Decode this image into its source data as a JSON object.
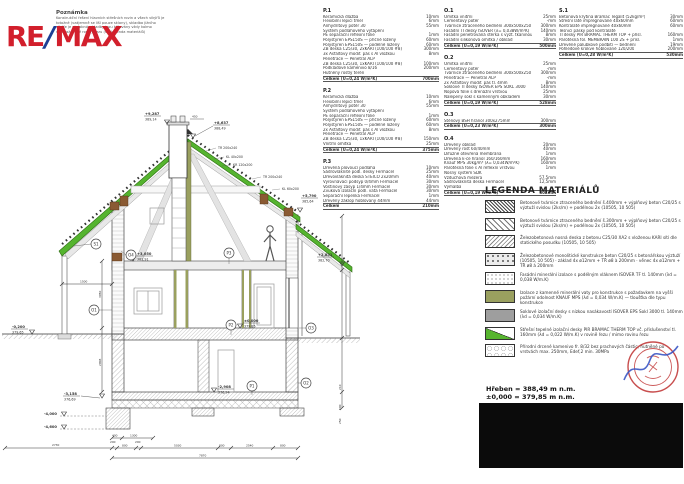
{
  "note": {
    "title": "Poznámka",
    "lines": [
      "Konstrukční řešení hlavních střešních rovin a všech vikýřů je",
      "totožné (vzájemně se liší pouze sklony), skladba jižního",
      "vikýře je obdobná, skladby jsou kótovány vždy kolmo",
      "na uvažované roviny řezu (viz legenda materiálů)"
    ]
  },
  "logo": {
    "re": "RE",
    "slash": "/",
    "max": "MAX"
  },
  "specs": {
    "p1": {
      "id": "P.1",
      "rows": [
        [
          "Keramická dlažba",
          "10mm"
        ],
        [
          "Flexibilní lepicí tmel",
          "6mm"
        ],
        [
          "Anhydritový potěr 30",
          "55mm"
        ],
        [
          "Systém podlahového vytápění",
          ""
        ],
        [
          "PE separační reflexní fólie",
          "1mm"
        ],
        [
          "Polystyren EPS150S — příčně ložený",
          "60mm"
        ],
        [
          "Polystyren EPS150S — podélně ložený",
          "60mm"
        ],
        [
          "ŽB deska C25/30, 2xKARI (100/100 #8)",
          "300mm"
        ],
        [
          "3x Asfaltový modif. pás s Al vložkou",
          "8mm"
        ],
        [
          "Penetrace — Penetral ALP",
          ""
        ],
        [
          "ŽB deska C25/30, 1xKARI (100/100 #8)",
          "100mm"
        ],
        [
          "Podkladové kamenivo 8/16",
          "200mm"
        ],
        [
          "Hutněný rostlý terén",
          ""
        ]
      ],
      "total": [
        "Celkem (U=0,24 W/m²K)",
        "700mm"
      ]
    },
    "p2": {
      "id": "P.2",
      "rows": [
        [
          "Keramická dlažba",
          "10mm"
        ],
        [
          "Flexibilní lepicí tmel",
          "6mm"
        ],
        [
          "Anhydritový potěr 30",
          "55mm"
        ],
        [
          "Systém podlahového vytápění",
          ""
        ],
        [
          "PE separační reflexní fólie",
          "1mm"
        ],
        [
          "Polystyren EPS150S — příčně ložený",
          "60mm"
        ],
        [
          "Polystyren EPS150S — podélně ložený",
          "60mm"
        ],
        [
          "2x Asfaltový modif. pás s Al vložkou",
          "8mm"
        ],
        [
          "Penetrace — Penetral ALP",
          ""
        ],
        [
          "ŽB deska C25/30, 1xKARI (100/100 #8)",
          "150mm"
        ],
        [
          "Vnitřní omítka",
          "25mm"
        ]
      ],
      "total": [
        "Celkem (U=0,24 W/m²K)",
        "375mm"
      ]
    },
    "p3": {
      "id": "P.3",
      "rows": [
        [
          "Dřevěná plovoucí podlaha",
          "10mm"
        ],
        [
          "Sádrovláknité podl. desky Fermacel",
          "25mm"
        ],
        [
          "Dřevovláknitá deska STEICO 2x20mm",
          "40mm"
        ],
        [
          "Vyrovnávací podsyp 0/4mm Fermacel",
          "30mm"
        ],
        [
          "Voštinový zásyp 1/4mm Fermacel",
          "30mm"
        ],
        [
          "Zvuková izolační podl. vata Fermacel",
          "30mm"
        ],
        [
          "Separační lepenka Fermacel",
          "1mm"
        ],
        [
          "Dřevěný záklop hoblovaný 44mm",
          "44mm"
        ]
      ],
      "total": [
        "Celkem",
        "210mm"
      ]
    },
    "o1": {
      "id": "O.1",
      "rows": [
        [
          "Omítka vnitřní",
          "25mm"
        ],
        [
          "Cementový potěr",
          "-mm"
        ],
        [
          "Tvárnice ztraceného bednění 300x500x250",
          "300mm"
        ],
        [
          "Fasádní TI desky ISOVER (λ= 0,038W/m²K)",
          "140mm"
        ],
        [
          "Fasádní penetrovaná stěrka s výzt. tkaninou",
          "8mm"
        ],
        [
          "Fasádní silikonová omítka / obklad",
          "30mm"
        ]
      ],
      "total": [
        "Celkem (U=0,19 W/m²K)",
        "500mm"
      ]
    },
    "o2": {
      "id": "O.2",
      "rows": [
        [
          "Omítka vnitřní",
          "25mm"
        ],
        [
          "Cementový potěr",
          "-mm"
        ],
        [
          "Tvárnice ztraceného bednění 300x500x250",
          "300mm"
        ],
        [
          "Penetrace — Penetral ALP",
          "-mm"
        ],
        [
          "2x Asfaltový modif. pás tl. 4mm",
          "8mm"
        ],
        [
          "Soklové TI desky ISOVER EPS SOKL 3000",
          "140mm"
        ],
        [
          "Nopová fólie s drenážní vrstvou",
          "25mm"
        ],
        [
          "Nalepený sokl s kamenným obkladem",
          "30mm"
        ]
      ],
      "total": [
        "Celkem (U=0,19 W/m²K)",
        "528mm"
      ]
    },
    "o3": {
      "id": "O.3",
      "rows": [
        [
          "Stěnový BSH hranol 300x275mm",
          "300mm"
        ]
      ],
      "total": [
        "Celkem (U=0,23 W/m²K)",
        "300mm"
      ]
    },
    "o4": {
      "id": "O.4",
      "rows": [
        [
          "Dřevěný obklad",
          "20mm"
        ],
        [
          "Dřevěný rošt 60/40mm",
          "40mm"
        ],
        [
          "Difúzně otevřená membrána",
          "1mm"
        ],
        [
          "Dřevěná k-ce hranol 160/160mm",
          "160mm"
        ],
        [
          "Knauf MPS 30kg/m³ (λ= 0,034W/m²K)",
          "160mm"
        ],
        [
          "Parotěsná fólie s Al reflexní vrstvou",
          "1mm"
        ],
        [
          "Nosný systém SDK",
          ""
        ],
        [
          "Vzduchová mezera",
          "57,5mm"
        ],
        [
          "Sádrovláknitá deska Fermacel",
          "12,5mm"
        ],
        [
          "Výmalba",
          ""
        ]
      ],
      "total": [
        "Celkem (U=0,19 W/m²K)",
        "302mm"
      ]
    },
    "s1": {
      "id": "S.1",
      "rows": [
        [
          "Betonová krytina Bramac Tegalit (52kg/m²)",
          "30mm"
        ],
        [
          "Střešní latě impregnované 40x60mm",
          "60mm"
        ],
        [
          "Kontralatě impregnované 40x60mm",
          "60mm"
        ],
        [
          "Těsnicí pásky pod kontralatě",
          ""
        ],
        [
          "TI desky PIR BRAMAC THERM TOP + přísl.",
          "160mm"
        ],
        [
          "Parotěsná fol. MEMBRAIN 100 2S + přísl.",
          "1mm"
        ],
        [
          "Dřevěné palubkové podbití — bednění",
          "19mm"
        ],
        [
          "Pohledové krokve hoblované 120/200",
          "200mm"
        ]
      ],
      "total": [
        "Celkem (U=0,28 W/m²K)",
        "530mm"
      ]
    }
  },
  "legend": {
    "title": "LEGENDA MATERIÁLŮ",
    "items": [
      {
        "swatch": "dark-block-hatch",
        "text": "Betonové tvárnice ztraceného bednění š.400mm + výplňový beton C20/25 s výztuží svislou (2ks/m) + podélnou 2x (10505, 10 505)"
      },
      {
        "swatch": "light-block-hatch",
        "text": "Betonové tvárnice ztraceného bednění š.300mm + výplňový beton C20/25 s výztuží svislou (2ks/m) + podélnou 2x (10505, 10 505)"
      },
      {
        "swatch": "rc-slab-hatch",
        "text": "Železobetonová nosná deska z betonu C25/30 XA2 s vloženou KARI sítí dle statického posudku (10505, 10 505)"
      },
      {
        "swatch": "concrete-dots",
        "text": "Železobetonové monolitické konstrukce beton C20/25 s betonářskou výztuží (10505, 10 505) · základ 4x ø12mm + TŘ ø8 à 200mm · věnec 4x ø12mm + TŘ ø8 à 200mm"
      },
      {
        "swatch": "mineral-dots",
        "text": "Fasádní minerální izolace s podélným vláknem ISOVER TF tl. 140mm (λd = 0,038 W/m.K)"
      },
      {
        "swatch": "olive-solid",
        "text": "Izolace z kamenné minerální vaty pro konstrukce s požadavkem na vyšší požární odolnost KNAUF MPS (λd = 0,034 W/m.K) — tloušťka dle typu konstrukce"
      },
      {
        "swatch": "grey-solid",
        "text": "Soklové izolační desky s nízkou nasákavostí ISOVER EPS Sokl 3000 tl. 140mm (λd = 0,034 W/m.K)"
      },
      {
        "swatch": "green-split",
        "text": "Střešní tepelné izolační desky PIR BRAMAC THERM TOP vč. příslušenství tl. 160mm (λd = 0,022 W/m.K) v rovině řezu / mimo rovinu řezu"
      },
      {
        "swatch": "gravel-circles",
        "text": "Přírodní drcené kamenivo fr. 8/32 bez prachových částic, hutněné po vrstvách max. 250mm, Edef,2 min. 30MPa"
      }
    ]
  },
  "levels": {
    "ridge": "Hřeben = 388,49 m n.m.",
    "zero": "±0,000 = 379,85 m n.m."
  },
  "drawing": {
    "elev": {
      "chimney": {
        "v": "+9,287",
        "d": "389,14"
      },
      "ridge": {
        "v": "+8,637",
        "d": "388,49"
      },
      "eave_r": {
        "v": "+5,790",
        "d": "385,64"
      },
      "eave_low": {
        "v": "+2,851",
        "d": "382,70"
      },
      "floor1": {
        "v": "+3,050",
        "d": "382,91"
      },
      "zero": {
        "v": "±0,000",
        "d": "379,85"
      },
      "grade": {
        "v": "-0,200",
        "d": "379,65"
      },
      "footing_top": {
        "v": "-3,158",
        "d": "376,69"
      },
      "bsm_floor": {
        "v": "-2,908",
        "d": "376,94"
      },
      "footing_a": {
        "v": "-4,000"
      },
      "footing_b": {
        "v": "-4,600"
      }
    },
    "members": {
      "tr1": "TR 200x240",
      "kl1": "KL 40x200",
      "kr1": "KR 120x200",
      "tr2": "TR 200x240",
      "kl2": "KL 60x200"
    },
    "bubbles": {
      "s1": "S1",
      "o1": "O1",
      "o2": "O2",
      "o3": "O3",
      "o4": "O4",
      "p1": "P1",
      "p2": "P2",
      "p3": "P3"
    },
    "dims": {
      "b1": "2730",
      "b2": "200",
      "b3": "800",
      "b4": "200",
      "b5": "5030",
      "b6": "800",
      "b7": "2540",
      "b8": "800",
      "total": "7870",
      "s1": "400",
      "s2": "1300",
      "left": "1500",
      "chimney": "450",
      "v1": "3050",
      "v2": "2908",
      "r1": "210",
      "r2": "500",
      "r3": "250"
    }
  }
}
